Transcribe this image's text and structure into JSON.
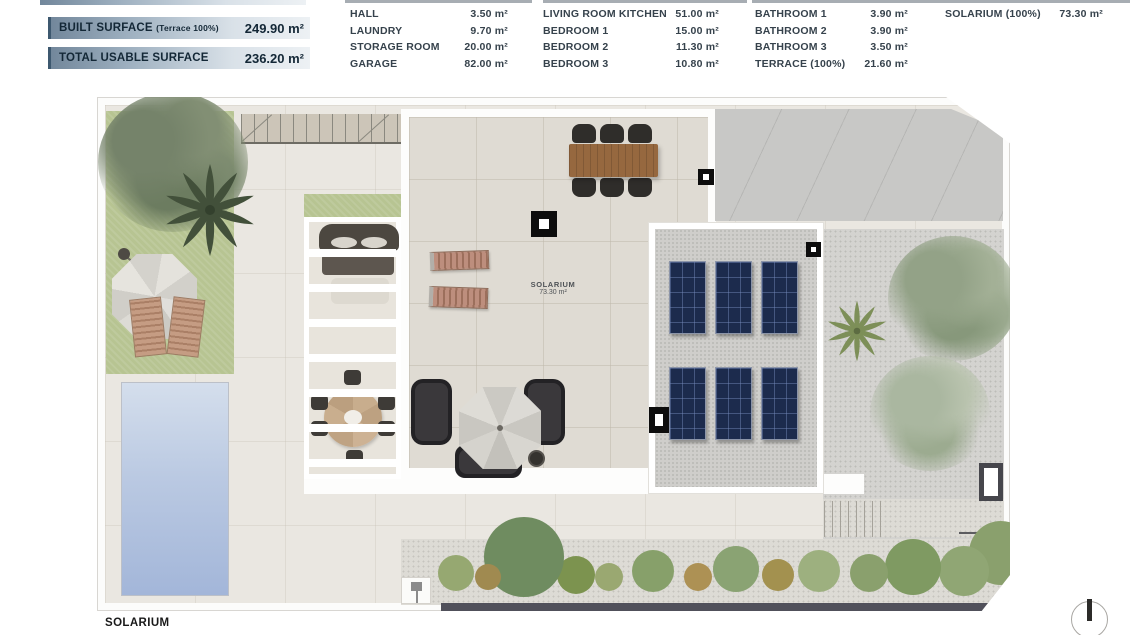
{
  "legend": {
    "summary": [
      {
        "label": "BUILT SURFACE",
        "qualifier": "(Terrace 100%)",
        "value": "249.90 m²"
      },
      {
        "label": "TOTAL USABLE SURFACE",
        "qualifier": "",
        "value": "236.20 m²"
      }
    ],
    "columns": [
      {
        "rows": [
          {
            "label": "HALL",
            "value": "3.50 m²"
          },
          {
            "label": "LAUNDRY",
            "value": "9.70 m²"
          },
          {
            "label": "STORAGE ROOM",
            "value": "20.00 m²"
          },
          {
            "label": "GARAGE",
            "value": "82.00 m²"
          }
        ]
      },
      {
        "rows": [
          {
            "label": "LIVING ROOM KITCHEN",
            "value": "51.00 m²"
          },
          {
            "label": "BEDROOM 1",
            "value": "15.00 m²"
          },
          {
            "label": "BEDROOM 2",
            "value": "11.30 m²"
          },
          {
            "label": "BEDROOM 3",
            "value": "10.80 m²"
          }
        ]
      },
      {
        "rows": [
          {
            "label": "BATHROOM 1",
            "value": "3.90 m²"
          },
          {
            "label": "BATHROOM 2",
            "value": "3.90 m²"
          },
          {
            "label": "BATHROOM 3",
            "value": "3.50 m²"
          },
          {
            "label": "TERRACE (100%)",
            "value": "21.60 m²"
          }
        ]
      },
      {
        "rows": [
          {
            "label": "SOLARIUM (100%)",
            "value": "73.30 m²"
          }
        ]
      }
    ]
  },
  "plan": {
    "room_label": {
      "name": "SOLARIUM",
      "area": "73.30 m²"
    },
    "caption": "SOLARIUM"
  },
  "colors": {
    "header_bar_start": "#72879b",
    "header_bar_end": "#edf1f4",
    "header_text": "#132736",
    "pool_blue": "#aebfe0",
    "solar_panel_navy": "#1c2b4d",
    "grass_green": "#b7c492",
    "tile_beige": "#dfdbd3",
    "gravel_gray": "#d4d3d0",
    "wall_dark": "#50505a"
  }
}
